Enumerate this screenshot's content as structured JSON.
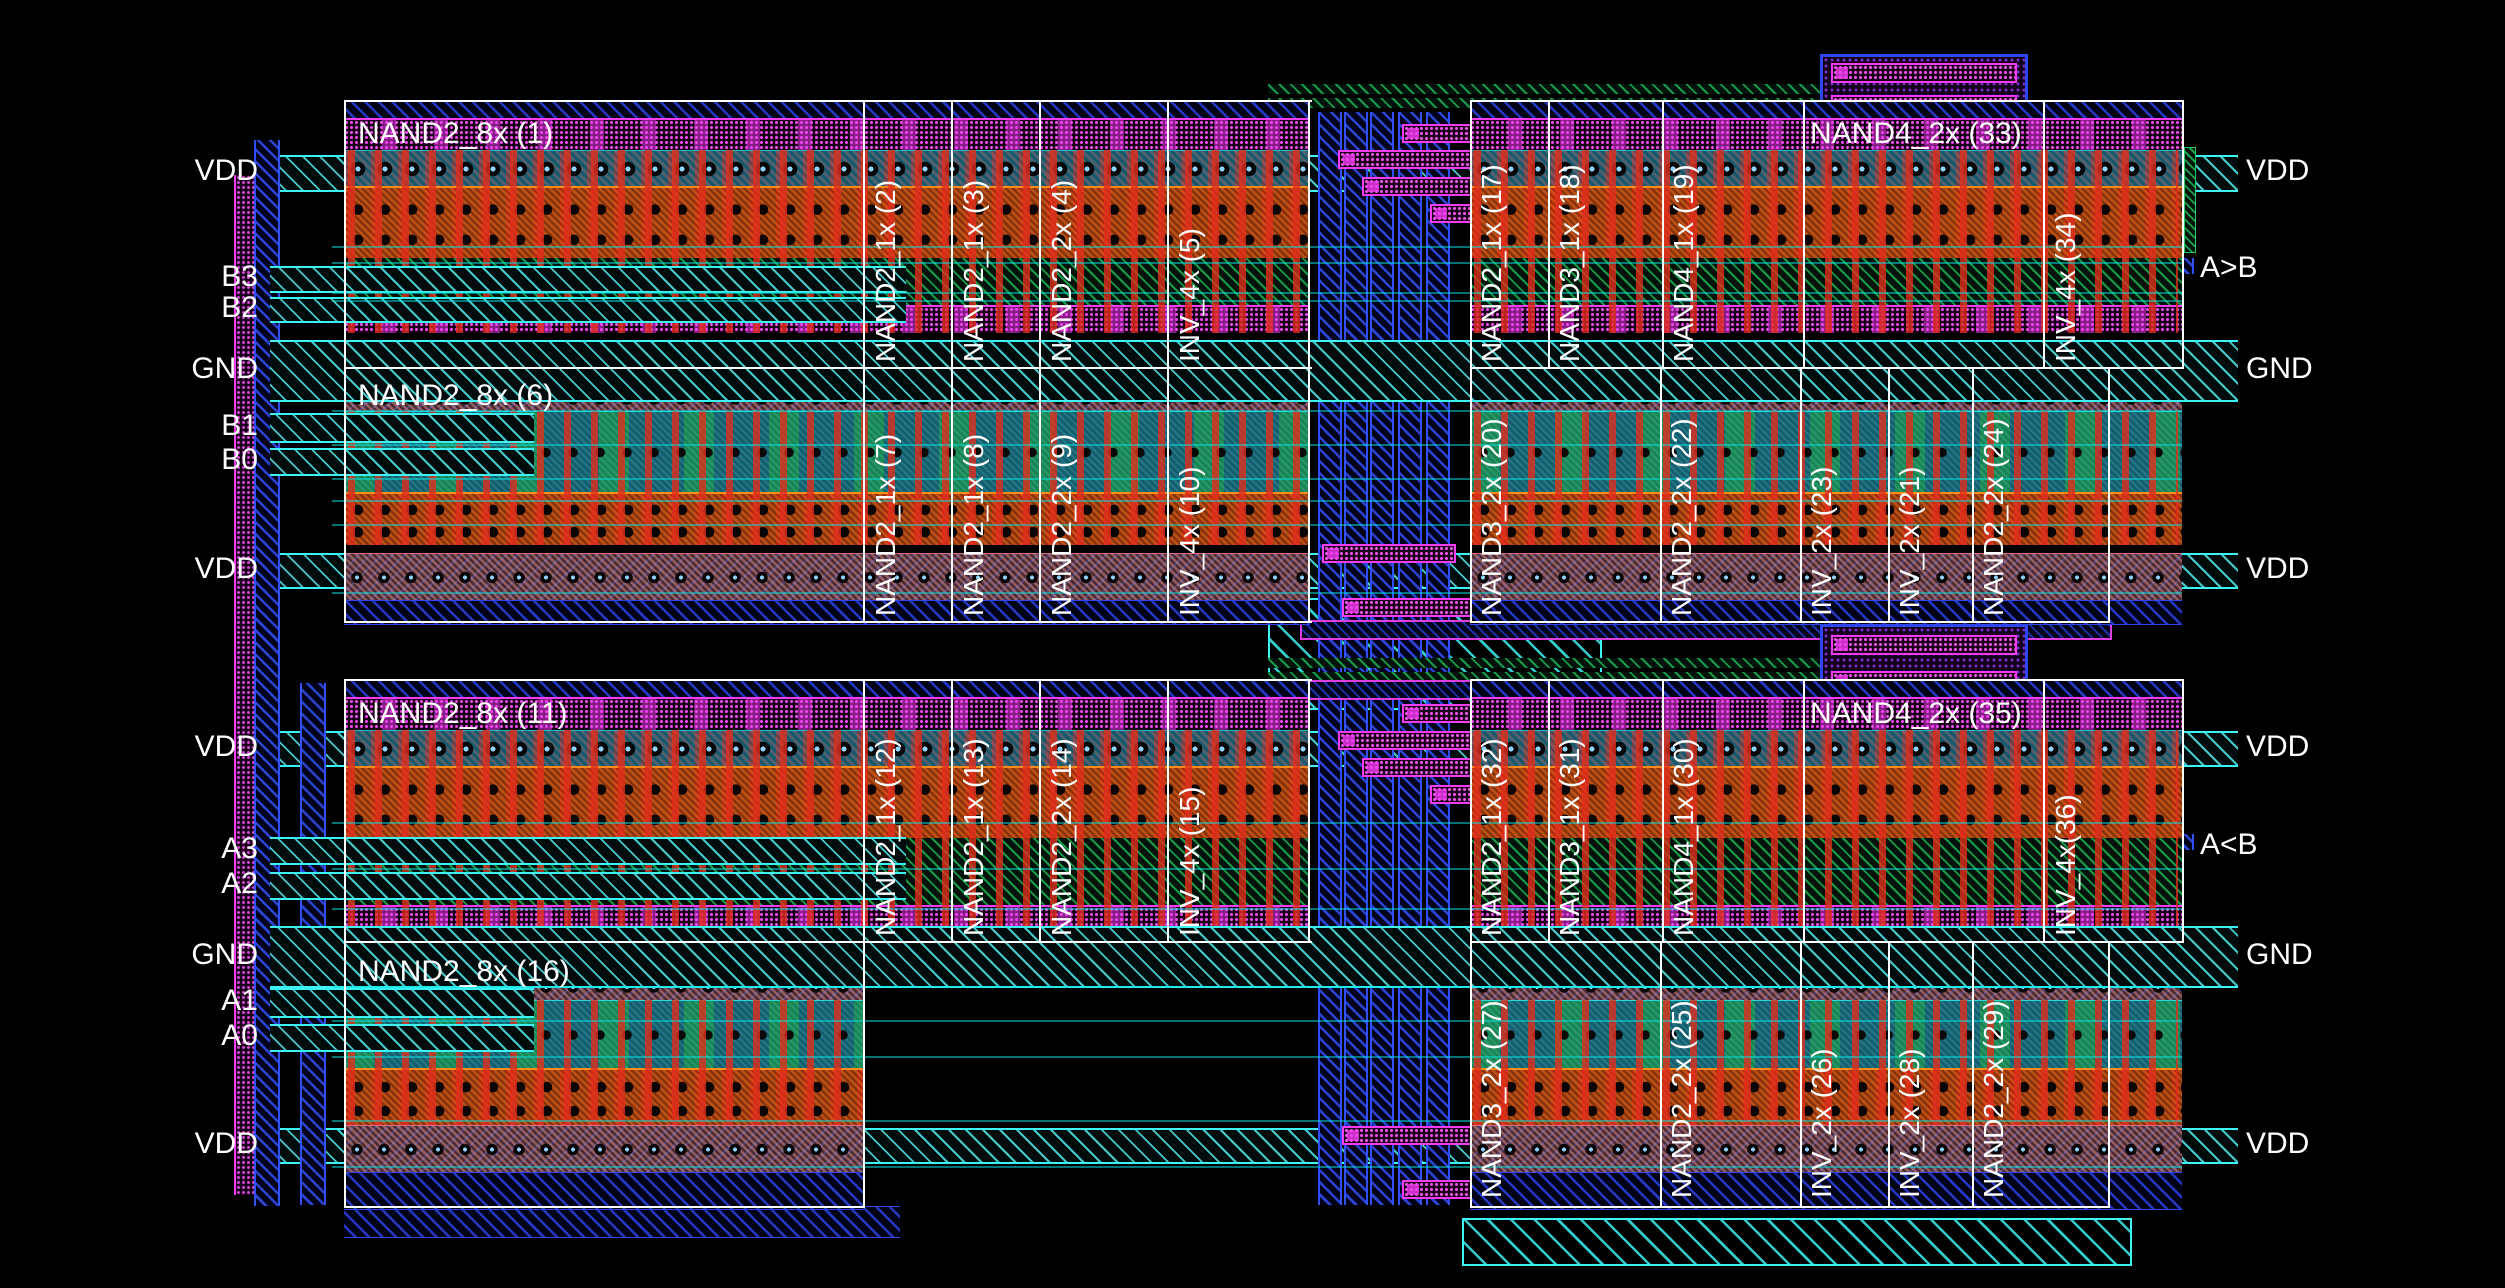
{
  "view": "ic-layout-4bit-magnitude-comparator",
  "colors": {
    "background": "#000000",
    "pin_band_cyan": "#3df2f2",
    "metal_blue": "#2d46f0",
    "via_magenta": "#f43cf4",
    "poly_red": "#e12d1c",
    "active_orange": "#ff8c1a",
    "well_green": "#1ec85f",
    "device_teal": "#23b8c8",
    "rail_pink": "#d86a8a",
    "outline_white": "#ffffff"
  },
  "pins": {
    "left": [
      "VDD",
      "B3",
      "B2",
      "GND",
      "B1",
      "B0",
      "VDD",
      "VDD",
      "A3",
      "A2",
      "GND",
      "A1",
      "A0",
      "VDD"
    ],
    "right": [
      "VDD",
      "A>B",
      "GND",
      "VDD",
      "VDD",
      "A<B",
      "GND",
      "VDD"
    ]
  },
  "cells": [
    "NAND2_8x (1)",
    "NAND2_1x (2)",
    "NAND2_1x (3)",
    "NAND2_2x (4)",
    "INV_4x (5)",
    "NAND2_8x (6)",
    "NAND2_1x (7)",
    "NAND2_1x (8)",
    "NAND2_2x (9)",
    "INV_4x (10)",
    "NAND2_8x (11)",
    "NAND2_1x (12)",
    "NAND2_1x (13)",
    "NAND2_2x (14)",
    "INV_4x (15)",
    "NAND2_8x (16)",
    "NAND2_1x (17)",
    "NAND3_1x (18)",
    "NAND4_1x (19)",
    "NAND4_2x (33)",
    "INV_4x (34)",
    "NAND3_2x (20)",
    "NAND2_2x (22)",
    "INV_2x (23)",
    "INV_2x (21)",
    "NAND2_2x (24)",
    "NAND2_1x (32)",
    "NAND3_1x (31)",
    "NAND4_1x (30)",
    "NAND4_2x (35)",
    "INV_4x(36)",
    "NAND3_2x (27)",
    "NAND2_2x (25)",
    "INV_2x (26)",
    "INV_2x (28)",
    "NAND2_2x (29)"
  ]
}
